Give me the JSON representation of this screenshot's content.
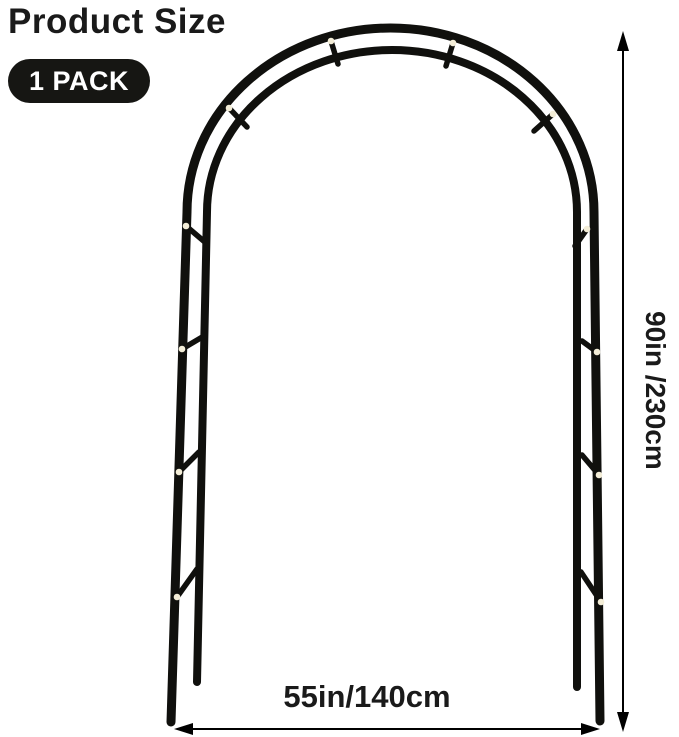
{
  "header": {
    "title": "Product Size",
    "badge": "1 PACK"
  },
  "diagram": {
    "subject": "garden arch arbor frame, front view, 1 pack",
    "height_label": "90in /230cm",
    "width_label": "55in/140cm",
    "joint_count": 12
  },
  "icons": {
    "vertical_arrow": "double-headed vertical dimension arrow",
    "horizontal_arrow": "double-headed horizontal dimension arrow"
  },
  "colors": {
    "structure": "#10100d",
    "joint_dot": "#f3edd7",
    "badge_bg": "#161613",
    "badge_text": "#ffffff",
    "text": "#1a1a1a",
    "arrow": "#000000",
    "page_bg": "#ffffff"
  }
}
